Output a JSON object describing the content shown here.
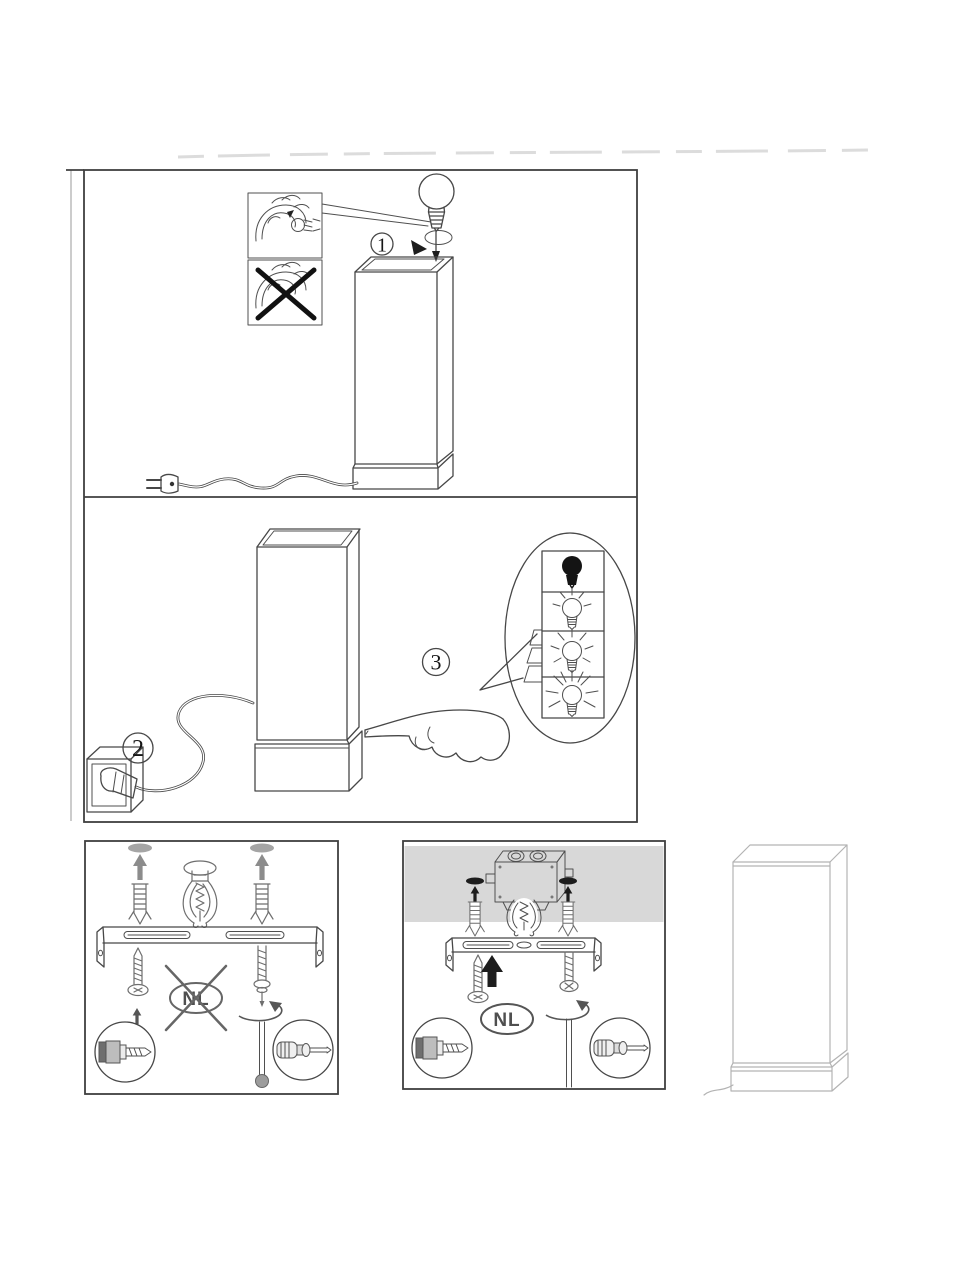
{
  "sheet": {
    "type_icon": "touch-lamp-assembly-instructions",
    "steps": [
      {
        "number": "1",
        "action_icon": "insert-bulb-into-lamp"
      },
      {
        "number": "2",
        "action_icon": "plug-cord-into-wall-outlet"
      },
      {
        "number": "3",
        "action_icon": "touch-lamp-base-to-dim"
      }
    ],
    "handling_insets": [
      {
        "icon": "hold-bulb-correctly"
      },
      {
        "icon": "wrong-handling-crossed-out"
      }
    ],
    "brightness_levels": [
      {
        "icon": "bulb-off"
      },
      {
        "icon": "bulb-low"
      },
      {
        "icon": "bulb-medium"
      },
      {
        "icon": "bulb-high"
      }
    ],
    "mounting_panels": [
      {
        "badge": "NL",
        "badge_crossed_out": true,
        "icons": [
          "wall-anchor",
          "claw-fixture",
          "mounting-bracket",
          "screw",
          "rotation-arrow",
          "wall-plug-detail",
          "screwdriver-detail"
        ]
      },
      {
        "badge": "NL",
        "badge_crossed_out": false,
        "icons": [
          "ceiling-junction-box",
          "wall-anchor",
          "mounting-bracket",
          "screw",
          "rotation-arrow",
          "wall-plug-detail",
          "screwdriver-detail"
        ]
      }
    ],
    "colors": {
      "line": "#474747",
      "border": "#3f3f3f",
      "light_line": "#b3b3b3",
      "ceiling_fill": "#d8d8d8",
      "junction_box_fill": "#c6c6c6",
      "black_fill": "#1d1d1d",
      "gray_fill": "#9c9c9c",
      "background": "#ffffff"
    }
  }
}
